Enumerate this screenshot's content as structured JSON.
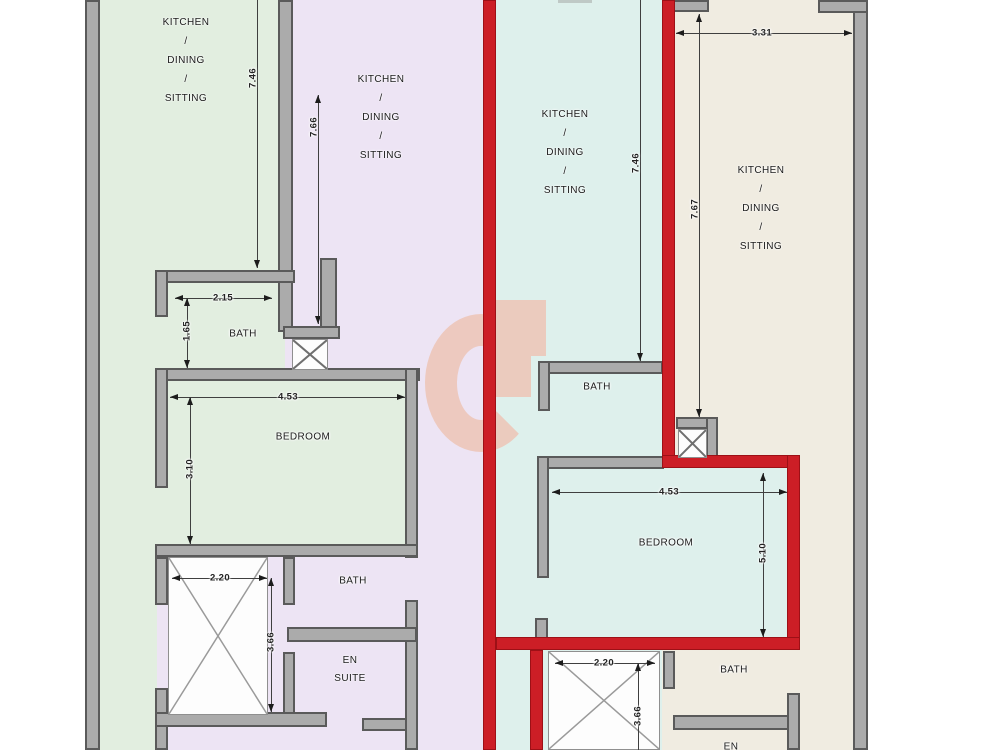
{
  "drawing": {
    "type": "residential floor plan, four apartment units, one unit highlighted in red",
    "colors": {
      "unit1_green": "#e2eee0",
      "unit2_lavender": "#ede4f4",
      "unit3_cyan_highlighted": "#def0ec",
      "unit4_beige": "#f0ece1",
      "highlight_outline": "#cc1e26",
      "wall_fill": "#ababab",
      "wall_edge": "#5a5a5a",
      "watermark": "#eec4b4"
    }
  },
  "rooms": {
    "unit1": {
      "kitchen": [
        "KITCHEN",
        "/",
        "DINING",
        "/",
        "SITTING"
      ],
      "bath": "BATH",
      "bedroom": "BEDROOM"
    },
    "unit2": {
      "kitchen": [
        "KITCHEN",
        "/",
        "DINING",
        "/",
        "SITTING"
      ],
      "bath": "BATH",
      "ensuite": [
        "EN",
        "SUITE"
      ]
    },
    "unit3": {
      "kitchen": [
        "KITCHEN",
        "/",
        "DINING",
        "/",
        "SITTING"
      ],
      "bath": "BATH",
      "bedroom": "BEDROOM"
    },
    "unit4": {
      "kitchen": [
        "KITCHEN",
        "/",
        "DINING",
        "/",
        "SITTING"
      ],
      "bath": "BATH",
      "ensuite_partial": "EN"
    }
  },
  "dims": {
    "u1_height": "7.46",
    "u2_height": "7.66",
    "u3_height": "7.46",
    "u4_height": "7.67",
    "u4_width": "3.31",
    "u1_bath_width": "2.15",
    "u1_bath_height": "1.65",
    "u1_bed_width": "4.53",
    "u1_bed_height": "3.10",
    "u1_shaft_width": "2.20",
    "u1_shaft_height": "3.66",
    "u3_bed_width": "4.53",
    "u3_bed_height": "5.10",
    "u3_shaft_width": "2.20",
    "u3_shaft_height": "3.66"
  }
}
